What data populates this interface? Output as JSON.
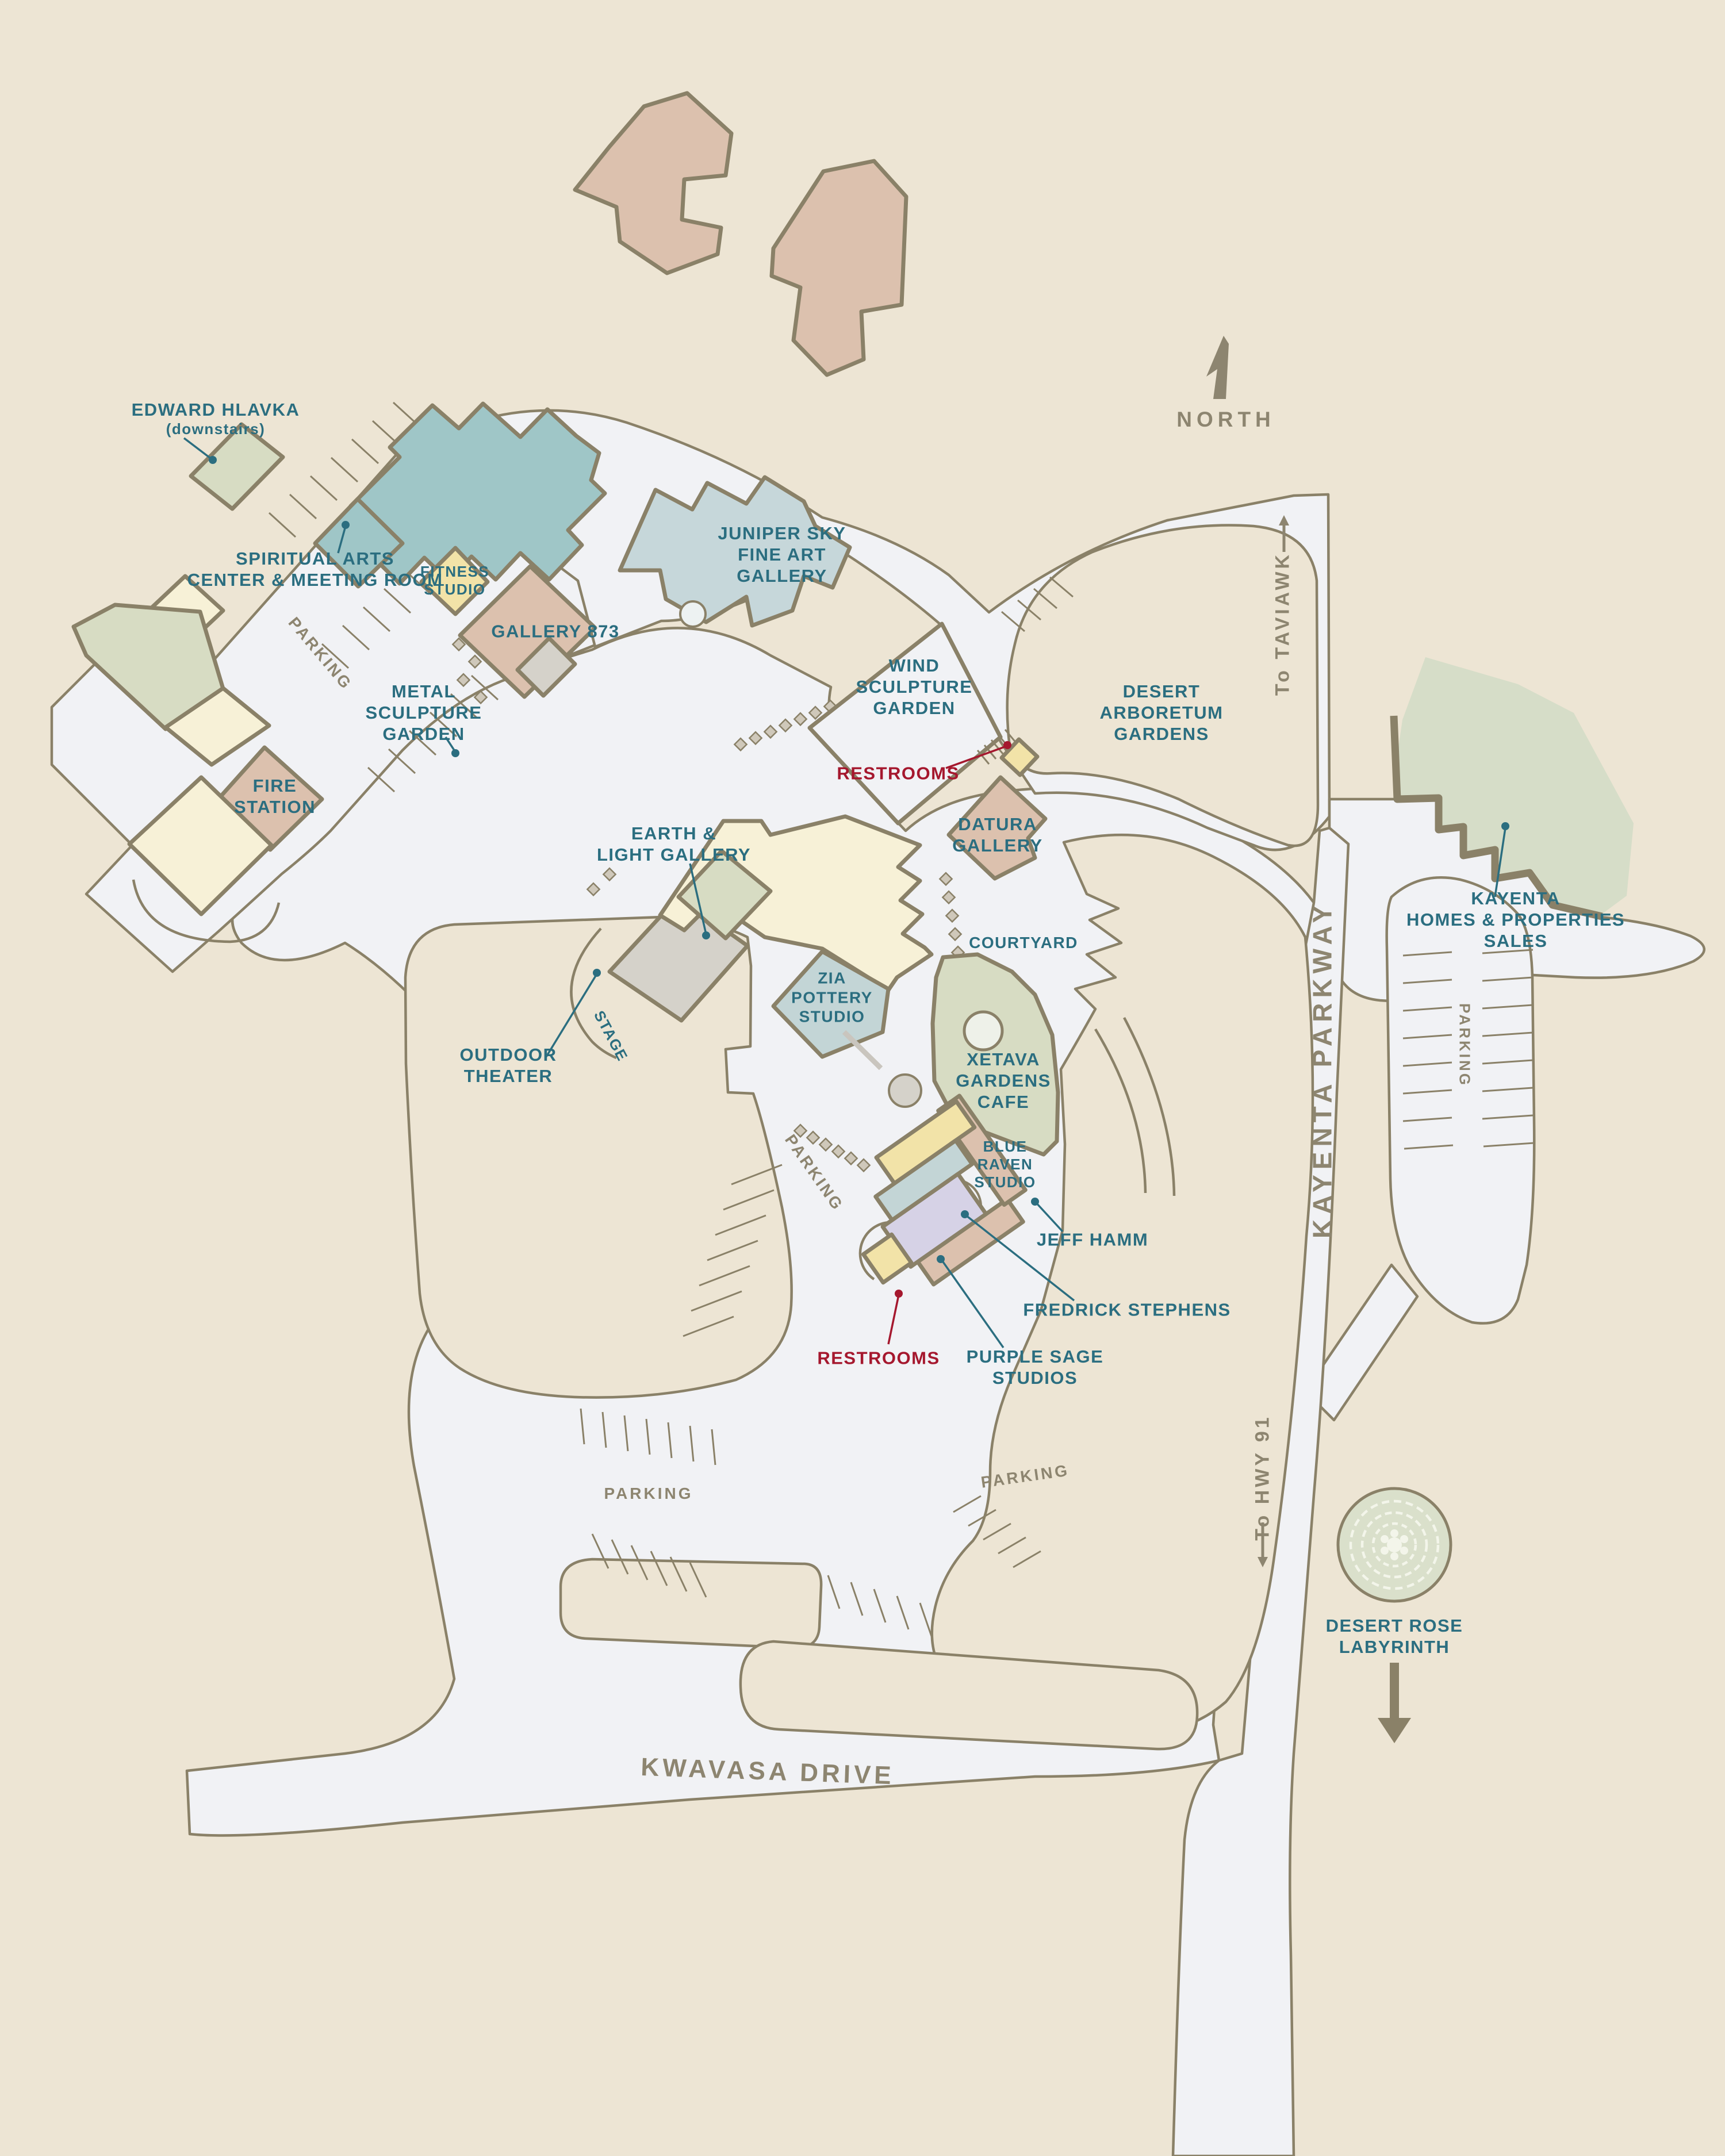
{
  "palette": {
    "bg": "#EDE5D4",
    "road": "#F1F2F5",
    "outline": "#8A8168",
    "label_teal": "#2B6E80",
    "label_red": "#A5182E",
    "label_road": "#8D8570",
    "teal_building": "#9FC6C7",
    "light_blue_building": "#C6D7DA",
    "pink_building": "#DCC1AE",
    "cream_building": "#F7F1D7",
    "yellow_building": "#F2E3A8",
    "sage_building": "#D7DCC3",
    "purple_building": "#D6D2E6",
    "bluegray_building": "#C3D5D6",
    "gray_building": "#D5D2CA",
    "green_zone": "#D6DDC8",
    "labyrinth_green": "#DAE0CB"
  },
  "labels": {
    "parking": "PARKING",
    "restrooms": "RESTROOMS"
  },
  "roads": {
    "kayenta_parkway": "KAYENTA PARKWAY",
    "kwavasa_drive": "KWAVASA DRIVE",
    "to_taviawk": "To TAVIAWK",
    "to_hwy_91": "To HWY 91"
  },
  "compass": {
    "north": "NORTH"
  },
  "places": {
    "edward_hlavka": {
      "l1": "EDWARD HLAVKA",
      "l2": "(downstairs)"
    },
    "spiritual_arts": {
      "l1": "SPIRITUAL ARTS",
      "l2": "CENTER & MEETING ROOM"
    },
    "fitness_studio": {
      "l1": "FITNESS",
      "l2": "STUDIO"
    },
    "gallery_873": {
      "l1": "GALLERY 873"
    },
    "metal_sculpture": {
      "l1": "METAL",
      "l2": "SCULPTURE",
      "l3": "GARDEN"
    },
    "juniper_sky": {
      "l1": "JUNIPER SKY",
      "l2": "FINE ART",
      "l3": "GALLERY"
    },
    "wind_sculpture": {
      "l1": "WIND",
      "l2": "SCULPTURE",
      "l3": "GARDEN"
    },
    "desert_arboretum": {
      "l1": "DESERT",
      "l2": "ARBORETUM",
      "l3": "GARDENS"
    },
    "kayenta_homes": {
      "l1": "KAYENTA",
      "l2": "HOMES & PROPERTIES",
      "l3": "SALES"
    },
    "earth_light": {
      "l1": "EARTH &",
      "l2": "LIGHT GALLERY"
    },
    "outdoor_theater": {
      "l1": "OUTDOOR",
      "l2": "THEATER"
    },
    "stage": {
      "l1": "STAGE"
    },
    "zia_pottery": {
      "l1": "ZIA",
      "l2": "POTTERY",
      "l3": "STUDIO"
    },
    "datura_gallery": {
      "l1": "DATURA",
      "l2": "GALLERY"
    },
    "courtyard": {
      "l1": "COURTYARD"
    },
    "xetava_cafe": {
      "l1": "XETAVA",
      "l2": "GARDENS",
      "l3": "CAFE"
    },
    "blue_raven": {
      "l1": "BLUE",
      "l2": "RAVEN",
      "l3": "STUDIO"
    },
    "jeff_hamm": {
      "l1": "JEFF HAMM"
    },
    "fredrick_stephens": {
      "l1": "FREDRICK STEPHENS"
    },
    "purple_sage": {
      "l1": "PURPLE SAGE",
      "l2": "STUDIOS"
    },
    "fire_station": {
      "l1": "FIRE",
      "l2": "STATION"
    },
    "desert_rose": {
      "l1": "DESERT ROSE",
      "l2": "LABYRINTH"
    }
  }
}
